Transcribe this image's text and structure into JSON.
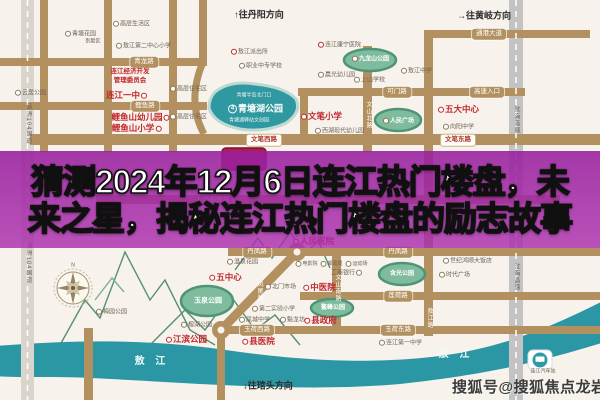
{
  "colors": {
    "overlay_purple": "#a32ca8",
    "road_tan": "#b2905f",
    "river_teal": "#2b96a4",
    "park_green": "#7fbc9e",
    "poi_red": "#c0262c",
    "expressway_gray": "#c3c3c3",
    "map_bg": "#f7f3ec"
  },
  "banner": {
    "line1": "猜测2024年12月6日连江热门楼盘，未",
    "line2": "来之星，揭秘连江热门楼盘的励志故事"
  },
  "watermark": {
    "text": "搜狐号@搜狐焦点龙岩站"
  },
  "directions": [
    {
      "t": "↑往丹阳方向",
      "x": 259,
      "y": 15
    },
    {
      "t": "→往黄岐方向",
      "x": 484,
      "y": 16
    },
    {
      "t": "↓往琯头方向",
      "x": 268,
      "y": 386
    }
  ],
  "river_labels": [
    {
      "t": "敖 江",
      "x": 152,
      "y": 362
    },
    {
      "t": "敖 江",
      "x": 456,
      "y": 355
    }
  ],
  "road_pills": [
    {
      "t": "青龙路",
      "x": 144,
      "y": 62,
      "s": "tan"
    },
    {
      "t": "鲤鱼路",
      "x": 145,
      "y": 106,
      "s": "tan"
    },
    {
      "t": "通港大道",
      "x": 489,
      "y": 34,
      "s": "tan"
    },
    {
      "t": "可门路",
      "x": 397,
      "y": 92,
      "s": "tan"
    },
    {
      "t": "高速入口",
      "x": 487,
      "y": 92,
      "s": "tan"
    },
    {
      "t": "马祖西路",
      "x": 216,
      "y": 200,
      "s": "tan"
    },
    {
      "t": "马祖路",
      "x": 336,
      "y": 200,
      "s": "tan"
    },
    {
      "t": "丹凤路",
      "x": 257,
      "y": 252,
      "s": "tan"
    },
    {
      "t": "丹凤路",
      "x": 398,
      "y": 252,
      "s": "tan"
    },
    {
      "t": "莲荷路",
      "x": 398,
      "y": 296,
      "s": "tan"
    },
    {
      "t": "玉荷西路",
      "x": 257,
      "y": 330,
      "s": "tan"
    },
    {
      "t": "玉荷东路",
      "x": 398,
      "y": 330,
      "s": "tan"
    },
    {
      "t": "文笔西路",
      "x": 264,
      "y": 140,
      "s": "white"
    },
    {
      "t": "文笔东路",
      "x": 458,
      "y": 140,
      "s": "white"
    }
  ],
  "road_vertical_labels": [
    {
      "t": "瀛洲104国道",
      "x": 28,
      "y": 124,
      "tone": "dark"
    },
    {
      "t": "瀛洲104国道",
      "x": 28,
      "y": 263,
      "tone": "dark"
    },
    {
      "t": "文山北路",
      "x": 368,
      "y": 115,
      "tone": "light"
    },
    {
      "t": "文山南路",
      "x": 337,
      "y": 288,
      "tone": "light"
    },
    {
      "t": "凤尾路",
      "x": 259,
      "y": 291,
      "tone": "light"
    },
    {
      "t": "敖江路",
      "x": 429,
      "y": 318,
      "tone": "light"
    },
    {
      "t": "沈海高速",
      "x": 516,
      "y": 120,
      "tone": "dark"
    },
    {
      "t": "沈海高速",
      "x": 516,
      "y": 277,
      "tone": "dark"
    }
  ],
  "pois": [
    {
      "t": "连江一中",
      "x": 127,
      "y": 95,
      "c": "red-lg",
      "b": "red",
      "bp": "after"
    },
    {
      "t": "鲤鱼山幼儿园",
      "x": 141,
      "y": 117,
      "c": "red-lg",
      "b": "red",
      "bp": "after"
    },
    {
      "t": "鲤鱼山小学",
      "x": 137,
      "y": 128,
      "c": "red-lg",
      "b": "red",
      "bp": "after"
    },
    {
      "t": "文笔小学",
      "x": 321,
      "y": 116,
      "c": "red-lg",
      "b": "red"
    },
    {
      "t": "五大中心",
      "x": 458,
      "y": 109,
      "c": "red-lg",
      "b": "red"
    },
    {
      "t": "五中心",
      "x": 225,
      "y": 277,
      "c": "red-lg",
      "b": "red"
    },
    {
      "t": "县政府",
      "x": 320,
      "y": 320,
      "c": "red-lg",
      "b": "red"
    },
    {
      "t": "县医院",
      "x": 258,
      "y": 341,
      "c": "red-lg",
      "b": "red"
    },
    {
      "t": "中医院",
      "x": 319,
      "y": 287,
      "c": "red-lg",
      "b": "red"
    },
    {
      "t": "人民医院",
      "x": 313,
      "y": 241,
      "c": "red-lg",
      "b": "red"
    },
    {
      "t": "江滨公园",
      "x": 186,
      "y": 339,
      "c": "red-lg",
      "b": "red"
    },
    {
      "t": "连江经济开发",
      "x": 130,
      "y": 72,
      "c": "red-sm"
    },
    {
      "t": "管理委员会",
      "x": 130,
      "y": 81,
      "c": "red-sm"
    },
    {
      "t": "青塘花园",
      "x": 80,
      "y": 34,
      "c": "gy",
      "b": "gray"
    },
    {
      "t": "别墅区",
      "x": 93,
      "y": 42,
      "c": "gy-xs"
    },
    {
      "t": "高层生活区",
      "x": 131,
      "y": 24,
      "c": "gy",
      "b": "gray"
    },
    {
      "t": "敖江第二中心小学",
      "x": 143,
      "y": 46,
      "c": "gy",
      "b": "gray"
    },
    {
      "t": "云居公园",
      "x": 30,
      "y": 93,
      "c": "gy",
      "b": "gray"
    },
    {
      "t": "高层住宅区",
      "x": 188,
      "y": 89,
      "c": "gy",
      "b": "gray"
    },
    {
      "t": "高层住宅区",
      "x": 188,
      "y": 117,
      "c": "gy",
      "b": "gray"
    },
    {
      "t": "职业中专学校",
      "x": 260,
      "y": 66,
      "c": "gy",
      "b": "gray"
    },
    {
      "t": "敖江派出所",
      "x": 249,
      "y": 52,
      "c": "gy",
      "b": "red"
    },
    {
      "t": "晨光幼儿园",
      "x": 336,
      "y": 75,
      "c": "gy",
      "b": "gray"
    },
    {
      "t": "上山学校",
      "x": 369,
      "y": 80,
      "c": "gy",
      "b": "gray"
    },
    {
      "t": "敖江中学",
      "x": 416,
      "y": 71,
      "c": "gy",
      "b": "gray"
    },
    {
      "t": "连江康宁医院",
      "x": 339,
      "y": 45,
      "c": "gy",
      "b": "red"
    },
    {
      "t": "向阳中学",
      "x": 458,
      "y": 127,
      "c": "gy",
      "b": "gray"
    },
    {
      "t": "西湖现代幼儿园",
      "x": 339,
      "y": 131,
      "c": "gy",
      "b": "gray"
    },
    {
      "t": "温泉花园",
      "x": 242,
      "y": 262,
      "c": "gy",
      "b": "gray"
    },
    {
      "t": "梅园公园",
      "x": 111,
      "y": 312,
      "c": "gy",
      "b": "gray"
    },
    {
      "t": "榕湖公园",
      "x": 196,
      "y": 325,
      "c": "gy",
      "b": "gray"
    },
    {
      "t": "北门市场",
      "x": 280,
      "y": 287,
      "c": "gy",
      "b": "gray"
    },
    {
      "t": "第二实验小学",
      "x": 273,
      "y": 309,
      "c": "gy",
      "b": "gray"
    },
    {
      "t": "凤城中学",
      "x": 254,
      "y": 320,
      "c": "gy",
      "b": "gray"
    },
    {
      "t": "魁龙坊",
      "x": 292,
      "y": 320,
      "c": "gy",
      "b": "gray"
    },
    {
      "t": "工商银行",
      "x": 347,
      "y": 273,
      "c": "gy",
      "b": "gray",
      "bp": "after"
    },
    {
      "t": "电影院",
      "x": 306,
      "y": 264,
      "c": "gy-xs",
      "b": "gray"
    },
    {
      "t": "邮政局",
      "x": 331,
      "y": 264,
      "c": "gy-xs",
      "b": "gray"
    },
    {
      "t": "运动场",
      "x": 356,
      "y": 264,
      "c": "gy-xs",
      "b": "gray"
    },
    {
      "t": "世纪鸿顺大饭店",
      "x": 467,
      "y": 261,
      "c": "gy",
      "b": "gray"
    },
    {
      "t": "时代广场",
      "x": 454,
      "y": 275,
      "c": "gy",
      "b": "gray"
    },
    {
      "t": "连江第一中学",
      "x": 400,
      "y": 343,
      "c": "gy",
      "b": "gray"
    },
    {
      "t": "连江汽车站",
      "x": 543,
      "y": 372,
      "c": "gy-xs"
    },
    {
      "t": "N",
      "x": 73,
      "y": 266,
      "c": "gy-xs"
    },
    {
      "t": "九龙山公园",
      "x": 370,
      "y": 59,
      "c": "wt",
      "b": "gray"
    },
    {
      "t": "人民广场",
      "x": 398,
      "y": 121,
      "c": "wt",
      "b": "gray"
    },
    {
      "t": "玉泉公园",
      "x": 208,
      "y": 301,
      "c": "wt-md"
    },
    {
      "t": "鳌峰公园",
      "x": 333,
      "y": 308,
      "c": "wt"
    },
    {
      "t": "含光公园",
      "x": 402,
      "y": 274,
      "c": "wt"
    },
    {
      "t": "青塘半岛北门口",
      "x": 254,
      "y": 96,
      "c": "wt-xs"
    },
    {
      "t": "青塘湖公园",
      "x": 255,
      "y": 109,
      "c": "wt-lg",
      "b": "num",
      "bc": "4"
    },
    {
      "t": "青塘湖驿站文创园",
      "x": 249,
      "y": 121,
      "c": "wt-xs"
    }
  ]
}
